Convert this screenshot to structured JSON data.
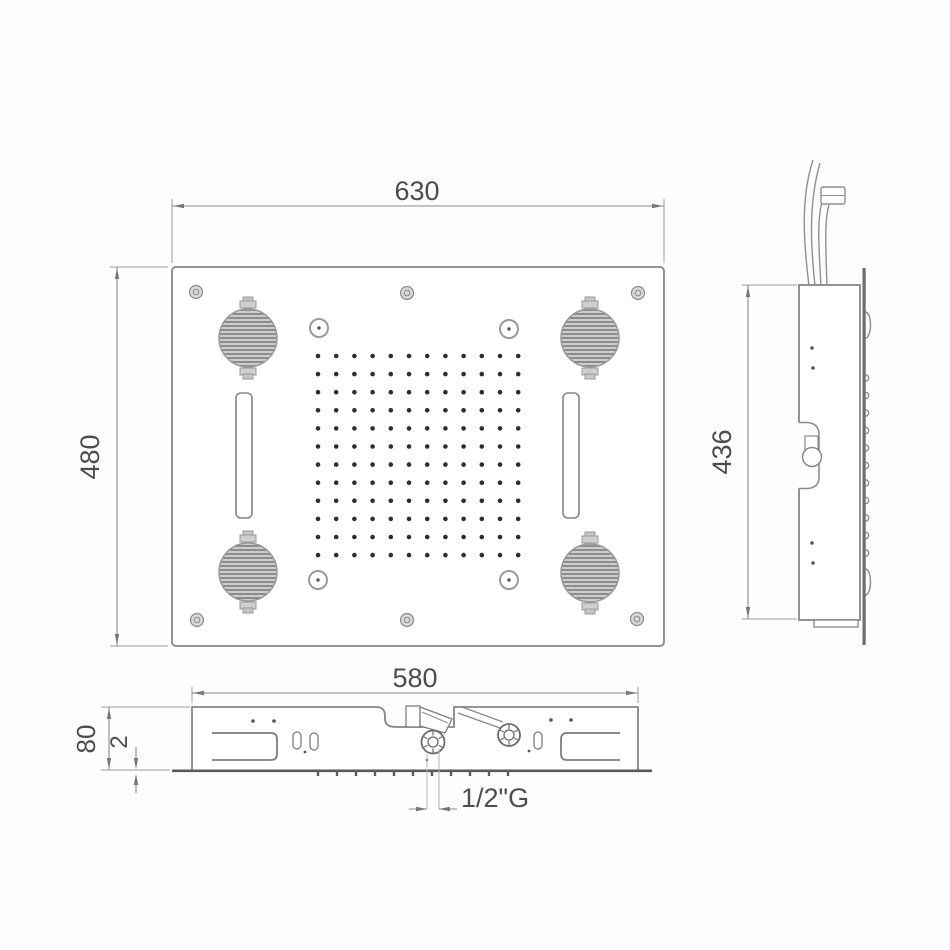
{
  "labels": {
    "front_width": "630",
    "front_height": "480",
    "side_height": "436",
    "body_width": "580",
    "body_depth": "80",
    "flange_thickness": "2",
    "connection_thread": "1/2\"G"
  },
  "front_view": {
    "nozzle_grid_rows": 12,
    "nozzle_grid_cols": 12,
    "speaker_count": 4,
    "light_count": 4,
    "screw_count": 6,
    "waterfall_slot_count": 2
  },
  "bottom_view": {
    "nozzle_tick_count": 11,
    "connection_count": 2
  },
  "side_view": {
    "nozzle_bump_count": 11,
    "cable_count": 4
  },
  "colors": {
    "line": "#868686",
    "dark_line": "#5a5a5a",
    "text": "#4d4d4d",
    "nozzle_dot": "#2e2e2e",
    "arrow": "#777777",
    "background": "#fdfdfd"
  }
}
